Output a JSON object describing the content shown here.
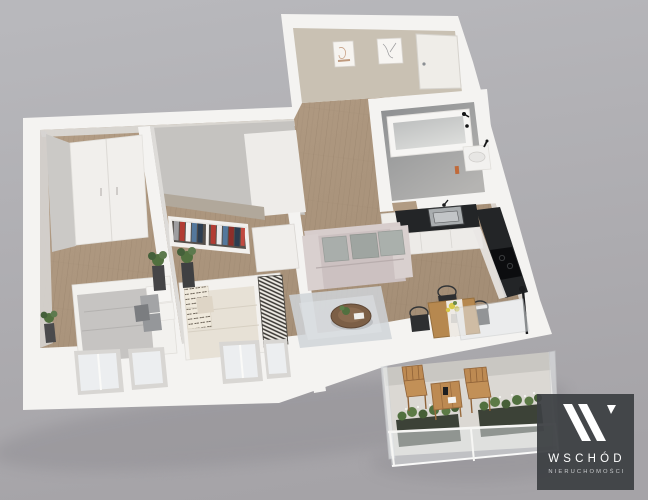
{
  "page": {
    "width": 648,
    "height": 500
  },
  "scene": {
    "type": "3d-floorplan-render",
    "rooms": [
      "entrance-hall",
      "bathroom",
      "kitchen",
      "living-room",
      "bedroom-1",
      "bedroom-2",
      "balcony"
    ]
  },
  "logo": {
    "brand": "WSCHÓD",
    "tagline": "NIERUCHOMOŚCI"
  },
  "colors": {
    "bgTop": "#b8b8bc",
    "bgBottom": "#a5a3a7",
    "wall": "#f4f3f1",
    "wallShade": "#d8d6d3",
    "beigeWall": "#c9c1b3",
    "wood": "#b49e86",
    "woodDark": "#a18b73",
    "bathFloor": "#9fa1a1",
    "counter": "#232527",
    "cooktop": "#0c0d0f",
    "sofa": "#ccc1c1",
    "cushion": "#a7aca8",
    "bedGray": "#c6c4c2",
    "bedCream": "#e7e1d6",
    "rug": "#cfd4d8",
    "tableWood": "#b6884f",
    "balconyWood": "#bd8a52",
    "greenery": "#51703f",
    "glass": "#e4e8ea",
    "logoBg": "#3d4043",
    "logoText": "#ffffff",
    "logoTagline": "#c9cbcd"
  }
}
